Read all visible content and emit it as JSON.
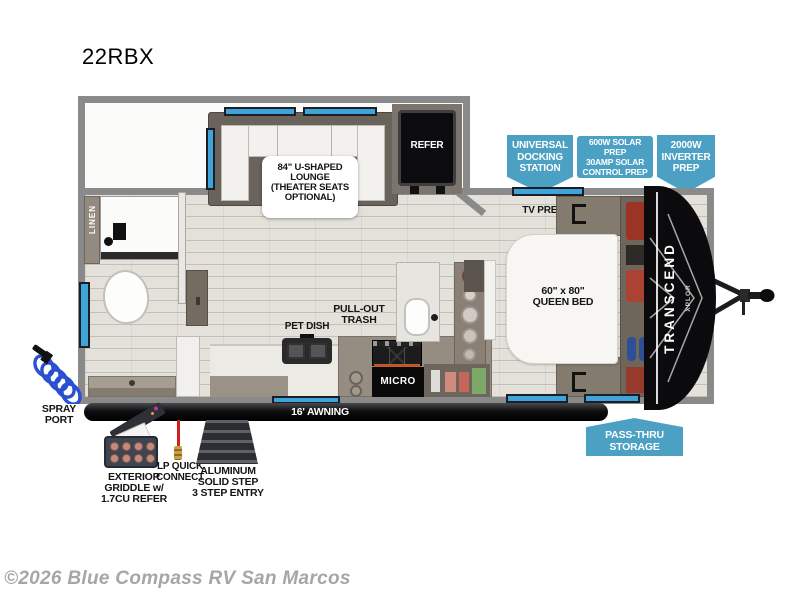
{
  "page": {
    "title": "22RBX",
    "watermark": "©2026 Blue Compass RV San Marcos"
  },
  "colors": {
    "badge_blue": "#4BA0C3",
    "window_blue": "#3EA4DA",
    "wall_gray": "#8A8A8A",
    "floor_tan": "#E4E1DB",
    "cabinet_taupe": "#958C82",
    "brand_black": "#0B0B0D",
    "lp_red": "#CF1F1F",
    "spray_blue": "#2A4FD0"
  },
  "badges": {
    "universal_docking": "UNIVERSAL\nDOCKING\nSTATION",
    "solar_prep": "600W SOLAR PREP\n30AMP SOLAR\nCONTROL PREP",
    "inverter_prep": "2000W\nINVERTER\nPREP",
    "pass_thru": "PASS-THRU\nSTORAGE"
  },
  "plan": {
    "lounge": "84\" U-SHAPED\nLOUNGE\n(THEATER SEATS\nOPTIONAL)",
    "refer": "REFER",
    "linen": "LINEN",
    "tv_prep": "TV PREP",
    "queen_bed": "60\" x 80\"\nQUEEN BED",
    "pull_out_trash": "PULL-OUT\nTRASH",
    "pet_dish": "PET DISH",
    "micro": "MICRO",
    "awning": "16' AWNING",
    "brand": "TRANSCEND",
    "brand_sub": "XPLOR"
  },
  "exterior": {
    "spray_port": "SPRAY\nPORT",
    "griddle": "EXTERIOR\nGRIDDLE w/\n1.7CU REFER",
    "lp_connect": "LP QUICK\nCONNECT",
    "steps": "ALUMINUM\nSOLID STEP\n3 STEP ENTRY"
  }
}
